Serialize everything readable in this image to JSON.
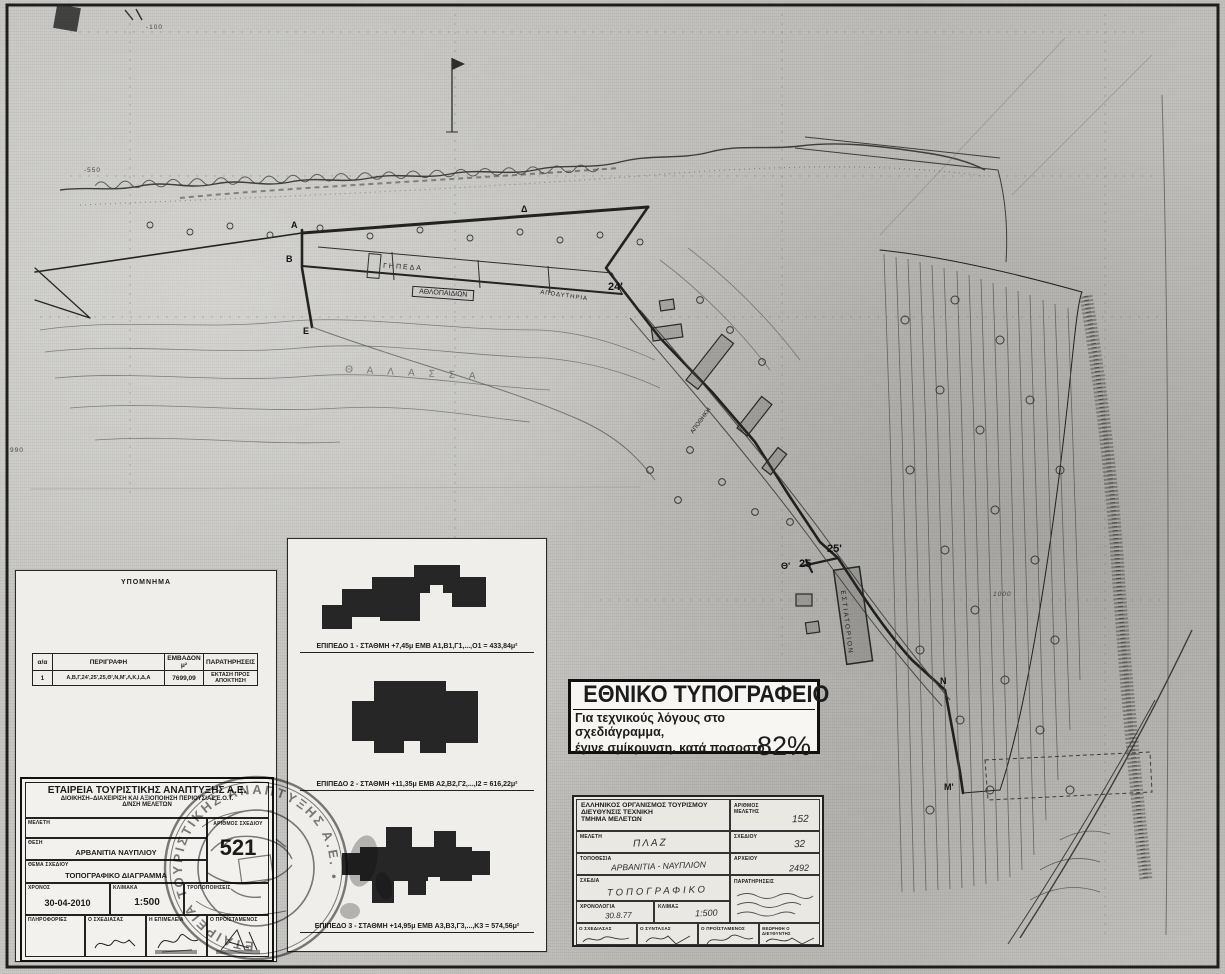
{
  "sheet": {
    "type_note": "scanned topographic survey sheet"
  },
  "map": {
    "labels": {
      "gipeda": "ΓΗΠΕΔΑ",
      "athlopaidion": "ΑΘΛΟΠΑΙΔΙΩΝ",
      "apodytiria": "ΑΠΟΔΥΤΗΡΙΑ",
      "apothiki": "ΑΠΟΘΗΚΗ",
      "estiatorion": "ΕΣΤΙΑΤΟΡΙΟΝ",
      "sea": "ΘΑΛΑΣΣΑ"
    },
    "vertices": [
      "Α",
      "Β",
      "Δ",
      "Ε",
      "24'",
      "25'",
      "Θ'",
      "25",
      "Ν",
      "Μ'"
    ],
    "grid_labels": [
      "-100",
      "-550",
      "990",
      "1000"
    ]
  },
  "legend_panel": {
    "title": "ΥΠΟΜΝΗΜΑ",
    "table": {
      "headers": [
        "α/α",
        "ΠΕΡΙΓΡΑΦΗ",
        "ΕΜΒΑΔΟΝ μ²",
        "ΠΑΡΑΤΗΡΗΣΕΙΣ"
      ],
      "rows": [
        [
          "1",
          "Α,Β,Γ,24',25',25,Θ',Ν,Μ',Λ,Κ,Ι,Δ,Α",
          "7699,09",
          "ΕΚΤΑΣΗ ΠΡΟΣ ΑΠΟΚΤΗΣΗ"
        ]
      ]
    }
  },
  "levels_panel": {
    "levels": [
      {
        "caption": "ΕΠΙΠΕΔΟ 1 - ΣΤΑΘΜΗ +7,45μ   ΕΜΒ Α1,Β1,Γ1,...,Ο1 = 433,84μ²"
      },
      {
        "caption": "ΕΠΙΠΕΔΟ 2 - ΣΤΑΘΜΗ +11,35μ   ΕΜΒ Α2,Β2,Γ2,...,Ι2 = 616,22μ²"
      },
      {
        "caption": "ΕΠΙΠΕΔΟ 3 - ΣΤΑΘΜΗ +14,95μ   ΕΜΒ Α3,Β3,Γ3,...,Κ3 = 574,56μ²"
      }
    ]
  },
  "printing_office": {
    "title": "ΕΘΝΙΚΟ ΤΥΠΟΓΡΑΦΕΙΟ",
    "line1": "Για τεχνικούς λόγους στο σχεδιάγραμμα,",
    "line2": "έγινε σμίκρυνση, κατά ποσοστό",
    "percent": "82%"
  },
  "title_block_new": {
    "org_line1": "ΕΤΑΙΡΕΙΑ ΤΟΥΡΙΣΤΙΚΗΣ ΑΝΑΠΤΥΞΗΣ Α.Ε.",
    "org_line2": "ΔΙΟΙΚΗΣΗ–ΔΙΑΧΕΙΡΙΣΗ ΚΑΙ ΑΞΙΟΠΟΙΗΣΗ ΠΕΡΙΟΥΣΙΑΣ Ε.Ο.Τ.",
    "org_line3": "Δ/ΝΣΗ ΜΕΛΕΤΩΝ",
    "meleti_label": "ΜΕΛΕΤΗ",
    "thesi_label": "ΘΕΣΗ",
    "thesi_value": "ΑΡΒΑΝΙΤΙΑ ΝΑΥΠΛΙΟΥ",
    "thema_label": "ΘΕΜΑ ΣΧΕΔΙΟΥ",
    "thema_value": "ΤΟΠΟΓΡΑΦΙΚΟ ΔΙΑΓΡΑΜΜΑ",
    "arithmos_label": "ΑΡΙΘΜΟΣ ΣΧΕΔΙΟΥ",
    "arithmos_value": "521",
    "xronos_label": "ΧΡΟΝΟΣ",
    "xronos_value": "30-04-2010",
    "klimaka_label": "ΚΛΙΜΑΚΑ",
    "klimaka_value": "1:500",
    "tropop_label": "ΤΡΟΠΟΠΟΙΗΣΕΙΣ",
    "bottom_labels": [
      "ΠΛΗΡΟΦΟΡΙΕΣ",
      "Ο ΣΧΕΔΙΑΣΑΣ",
      "Η ΕΠΙΜΕΛΕΙΑ",
      "Ο ΠΡΟΪΣΤΑΜΕΝΟΣ"
    ]
  },
  "title_block_eot": {
    "org_line1": "ΕΛΛΗΝΙΚΟΣ ΟΡΓΑΝΙΣΜΟΣ ΤΟΥΡΙΣΜΟΥ",
    "org_line2": "ΔΙΕΥΘΥΝΣΙΣ ΤΕΧΝΙΚΗ",
    "org_line3": "ΤΜΗΜΑ ΜΕΛΕΤΩΝ",
    "ar_meletis_label": "ΑΡΙΘΜΟΣ ΜΕΛΕΤΗΣ",
    "ar_meletis_value": "152",
    "meleti_label": "ΜΕΛΕΤΗ",
    "meleti_value": "ΠΛΑΖ",
    "sxediou_label": "ΣΧΕΔΙΟΥ",
    "sxediou_value": "32",
    "topothesia_label": "ΤΟΠΟΘΕΣΙΑ",
    "topothesia_value": "ΑΡΒΑΝΙΤΙΑ - ΝΑΥΠΛΙΟΝ",
    "arxeiou_label": "ΑΡΧΕΙΟΥ",
    "arxeiou_value": "2492",
    "sxedia_label": "ΣΧΕΔΙΑ",
    "sxedia_value": "ΤΟΠΟΓΡΑΦΙΚΟ",
    "xronologia_label": "ΧΡΟΝΟΛΟΓΙΑ",
    "xronologia_value": "30.8.77",
    "klimax_label": "ΚΛΙΜΑΞ",
    "klimax_value": "1:500",
    "paratiriseis_label": "ΠΑΡΑΤΗΡΗΣΕΙΣ",
    "bottom_labels": [
      "Ο ΣΧΕΔΙΑΣΑΣ",
      "Ο ΣΥΝΤΑΞΑΣ",
      "Ο ΠΡΟΪΣΤΑΜΕΝΟΣ",
      "ΘΕΩΡΗΘΗ Ο ΔΙΕΥΘΥΝΤΗΣ"
    ]
  },
  "stamp": {
    "text": "ΕΤΑΙΡΕΙΑ ΤΟΥΡΙΣΤΙΚΗΣ ΑΝΑΠΤΥΞΗΣ Α.Ε. • "
  }
}
